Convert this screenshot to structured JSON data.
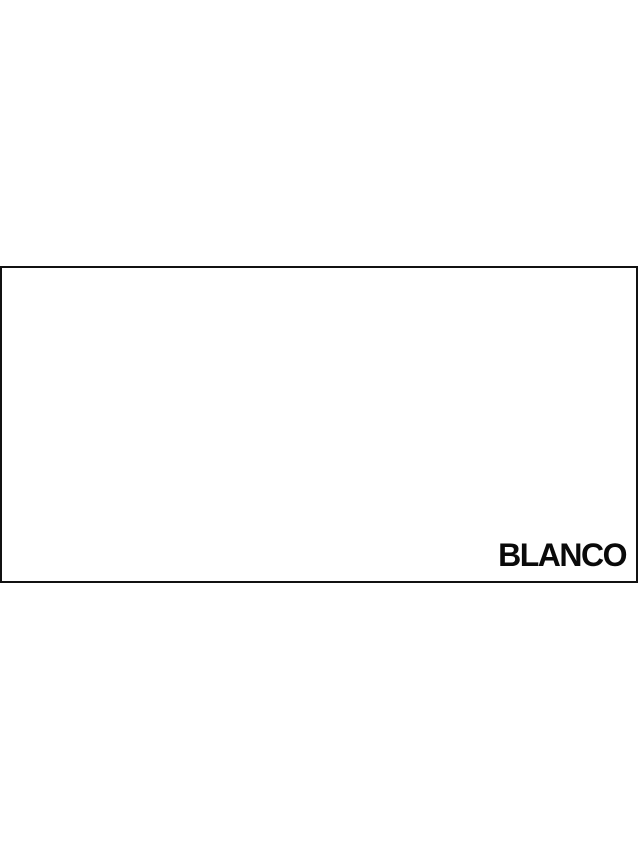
{
  "swatch": {
    "label": "BLANCO"
  },
  "colors": {
    "page_background": "#ffffff",
    "swatch_fill": "#ffffff",
    "swatch_border": "#111111",
    "label_text": "#0a0a0a"
  }
}
